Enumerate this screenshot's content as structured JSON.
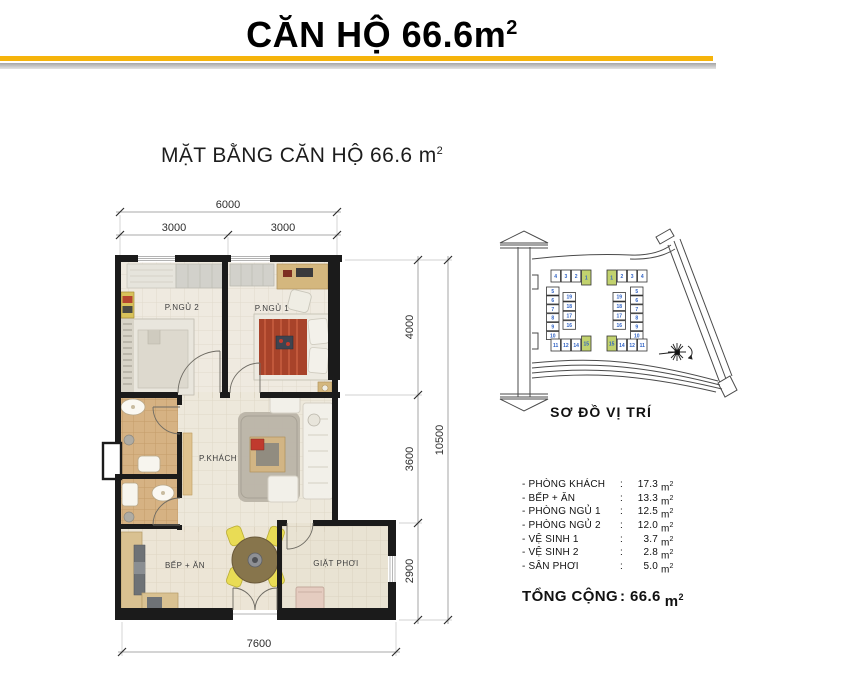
{
  "header": {
    "title": "CĂN HỘ 66.6m",
    "title_sup": "2"
  },
  "accent": {
    "yellow": "#F6B40B",
    "gray": "#ABABAB"
  },
  "plan": {
    "heading": "MẶT BẰNG CĂN HỘ 66.6 m",
    "heading_sup": "2",
    "rooms": {
      "bedroom2": "P.NGỦ 2",
      "bedroom1": "P.NGỦ 1",
      "living": "P.KHÁCH",
      "kitchen": "BẾP + ĂN",
      "laundry": "GIẶT PHƠI"
    },
    "dims": {
      "top_total": "6000",
      "top_left": "3000",
      "top_right": "3000",
      "side_top": "4000",
      "side_mid": "3600",
      "side_bottom": "2900",
      "side_total": "10500",
      "bottom_total": "7600"
    }
  },
  "site": {
    "label": "SƠ ĐỒ VỊ TRÍ",
    "number_color": "#2F62C4",
    "highlight_color": "#C2D26E",
    "left_cluster": {
      "top_row": [
        "4",
        "3",
        "2",
        "1"
      ],
      "side_col": [
        "5",
        "6",
        "7",
        "8",
        "9",
        "10"
      ],
      "inner_col": [
        "19",
        "18",
        "17",
        "16"
      ],
      "bottom_row": [
        "11",
        "12",
        "14",
        "15"
      ],
      "highlighted": [
        "1",
        "15"
      ]
    },
    "right_cluster": {
      "top_row": [
        "1",
        "2",
        "3",
        "4"
      ],
      "side_col": [
        "5",
        "6",
        "7",
        "8",
        "9",
        "10"
      ],
      "inner_col": [
        "19",
        "18",
        "17",
        "16"
      ],
      "bottom_row": [
        "15",
        "14",
        "12",
        "11"
      ],
      "highlighted": [
        "1",
        "15"
      ]
    }
  },
  "areas": {
    "separator": ":",
    "unit": "m",
    "unit_sup": "2",
    "rows": [
      {
        "label": "- PHÒNG KHÁCH",
        "value": "17.3"
      },
      {
        "label": "- BẾP + ĂN",
        "value": "13.3"
      },
      {
        "label": "- PHÒNG NGỦ 1",
        "value": "12.5"
      },
      {
        "label": "- PHÒNG NGỦ 2",
        "value": "12.0"
      },
      {
        "label": "- VỆ SINH 1",
        "value": "3.7"
      },
      {
        "label": "- VỆ SINH 2",
        "value": "2.8"
      },
      {
        "label": "- SÂN PHƠI",
        "value": "5.0"
      }
    ],
    "total": {
      "label": "TỔNG CỘNG",
      "value": "66.6"
    }
  }
}
